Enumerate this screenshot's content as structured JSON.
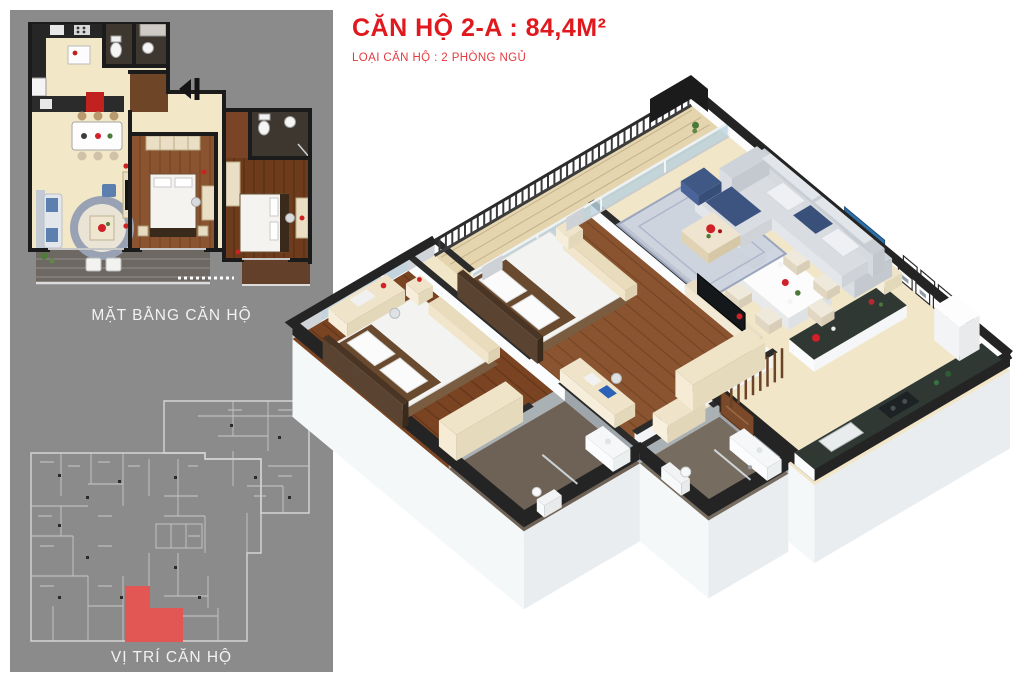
{
  "window": {
    "width": 1024,
    "height": 682,
    "background": "#ffffff"
  },
  "header": {
    "title": "CĂN HỘ 2-A : 84,4M²",
    "subtitle": "LOẠI CĂN HỘ : 2 PHÒNG NGỦ",
    "unit_code": "2-A",
    "area_label": "84,4M²",
    "unit_type_bedrooms": "2",
    "title_color": "#e0191f"
  },
  "sidebar": {
    "background": "#8b8b8b",
    "floorplan_caption": "MẶT BẰNG CĂN HỘ",
    "location_caption": "VỊ TRÍ CĂN HỘ",
    "location_highlight_color": "#e25653",
    "location_line_color": "#d5d5d5",
    "icons": [
      {
        "name": "entrance-arrow-icon",
        "glyph": "◀"
      }
    ]
  },
  "palette": {
    "wall_dark": "#242424",
    "floor_cream": "#f1e6c8",
    "wood_bedroom_1": "#8a5430",
    "wood_bedroom_2": "#6e3c1d",
    "bath_floor": "#77695c",
    "balcony_gray": "#6e6862",
    "glass_blue": "#bdd3e0",
    "sofa_gray": "#d9dde2",
    "counter_top_dark": "#2f3833",
    "accent_red": "#cf2127"
  }
}
